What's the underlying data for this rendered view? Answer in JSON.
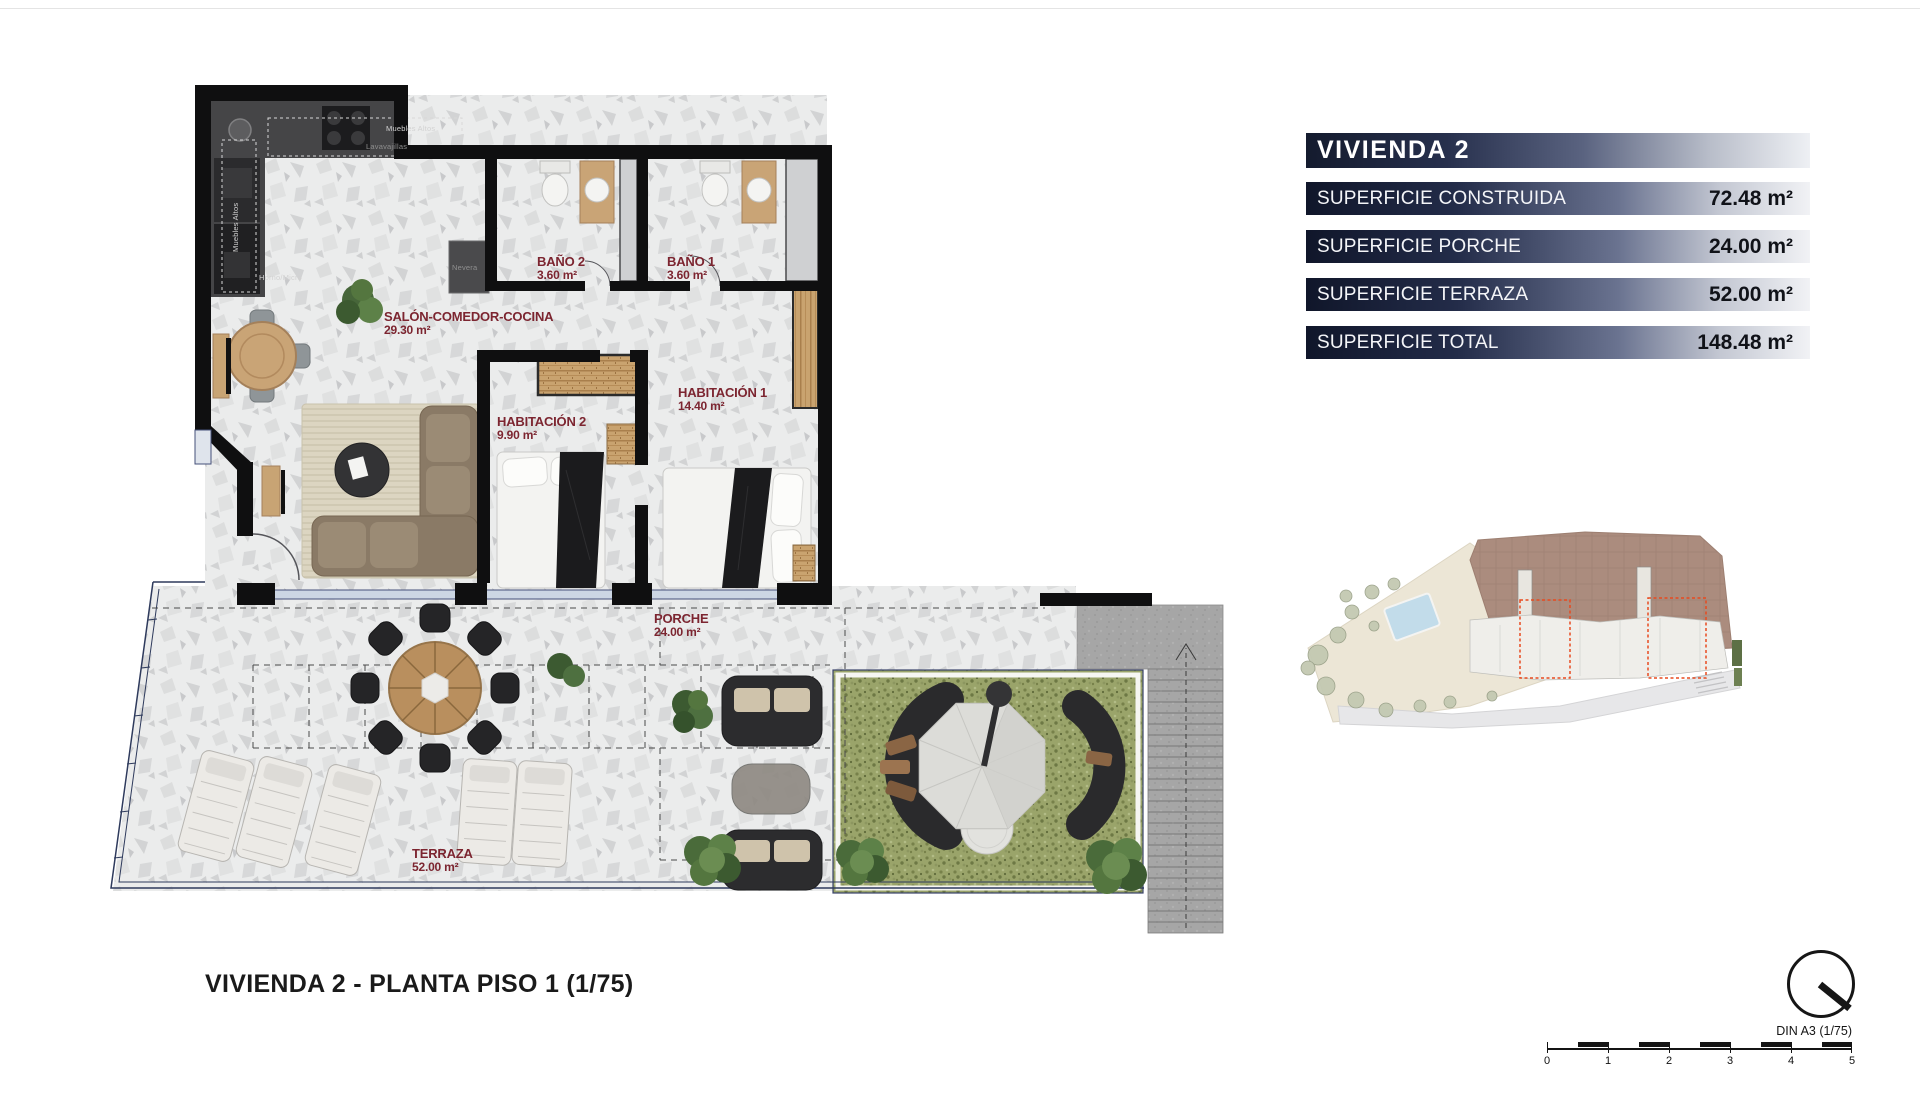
{
  "sheet": {
    "drawing_title": "VIVIENDA 2 - PLANTA PISO 1 (1/75)"
  },
  "info_panel": {
    "title": "VIVIENDA 2",
    "rows": [
      {
        "label": "SUPERFICIE CONSTRUIDA",
        "value": "72.48 m²"
      },
      {
        "label": "SUPERFICIE PORCHE",
        "value": "24.00 m²"
      },
      {
        "label": "SUPERFICIE TERRAZA",
        "value": "52.00 m²"
      }
    ],
    "total": {
      "label": "SUPERFICIE TOTAL",
      "value": "148.48 m²"
    }
  },
  "floor_plan": {
    "rooms": [
      {
        "name": "SALÓN-COMEDOR-COCINA",
        "area": "29.30 m²"
      },
      {
        "name": "BAÑO 2",
        "area": "3.60 m²"
      },
      {
        "name": "BAÑO 1",
        "area": "3.60 m²"
      },
      {
        "name": "HABITACIÓN 2",
        "area": "9.90 m²"
      },
      {
        "name": "HABITACIÓN 1",
        "area": "14.40 m²"
      },
      {
        "name": "PORCHE",
        "area": "24.00 m²"
      },
      {
        "name": "TERRAZA",
        "area": "52.00 m²"
      }
    ],
    "kitchen_labels": {
      "upper_cabinets_top": "Muebles Altos",
      "dishwasher": "Lavavajillas",
      "upper_cabinets_left": "Muebles Altos",
      "oven_micro": "Horno/Micro",
      "fridge": "Nevera"
    }
  },
  "scale_bar": {
    "sheet_label": "DIN A3 (1/75)",
    "ticks": [
      "0",
      "1",
      "2",
      "3",
      "4",
      "5"
    ]
  },
  "colors": {
    "room_label": "#7c2530",
    "header_navy": "#141b2e",
    "grass": "#9aa46a",
    "roof": "#ab8c7e",
    "highlight_red": "#e84a1f",
    "boundary_navy": "#2e3a5c"
  }
}
